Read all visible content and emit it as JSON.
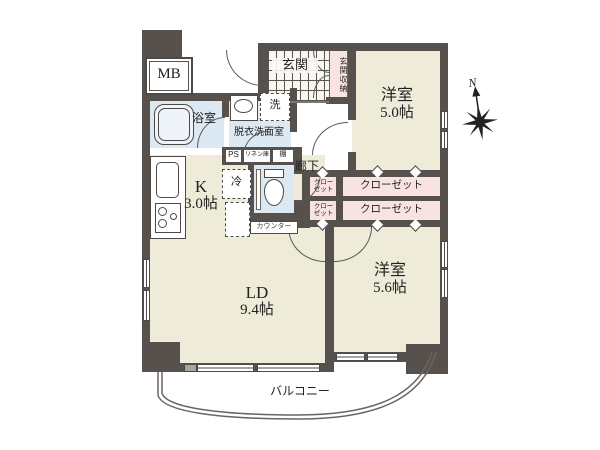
{
  "colors": {
    "wall": "#57514e",
    "floor_cream": "#eeebd8",
    "water_blue": "#dce9f2",
    "storage_pink": "#f8e3e1"
  },
  "compass": {
    "north": "N"
  },
  "labels": {
    "mb": "MB",
    "bathroom": "浴室",
    "washroom": "脱衣洗面室",
    "washer": "洗",
    "entrance": "玄関",
    "entrance_storage": "玄関収納",
    "hallway": "廊下",
    "ps": "PS",
    "linen": "リネン庫",
    "shelf": "棚",
    "fridge": "冷",
    "counter": "カウンター",
    "balcony": "バルコニー"
  },
  "rooms": {
    "bedroom1": {
      "name": "洋室",
      "size": "5.0帖"
    },
    "bedroom2": {
      "name": "洋室",
      "size": "5.6帖"
    },
    "kitchen": {
      "name": "K",
      "size": "3.0帖"
    },
    "living": {
      "name": "LD",
      "size": "9.4帖"
    }
  },
  "closets": {
    "small_line1": "クロー",
    "small_line2": "ゼット",
    "large": "クローゼット"
  }
}
